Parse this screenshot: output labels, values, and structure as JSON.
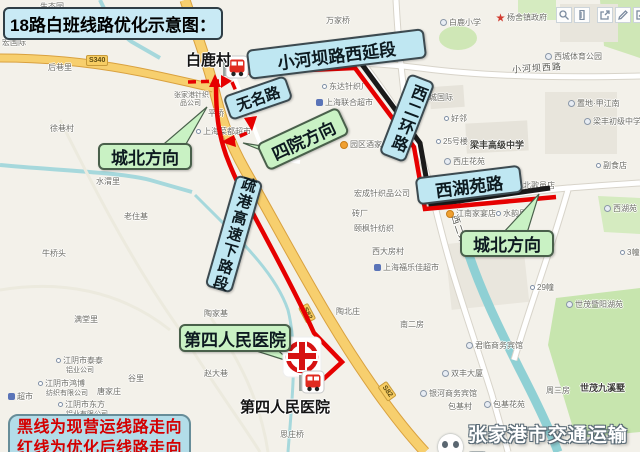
{
  "title": "18路白班线路优化示意图：",
  "legend": {
    "line1": "黑线为现营运线路走向",
    "line2": "红线为优化后线路走向"
  },
  "watermark": "张家港市交通运输局",
  "callouts": {
    "xiaoheba": "小河坝路西延段",
    "wuming": "无名路",
    "siyuan": "四院方向",
    "xierhuan": "西二环路",
    "xihuyuan": "西湖苑路",
    "chengbei_left": "城北方向",
    "chengbei_right": "城北方向",
    "shugang": "疏港高速下路段",
    "hospital": "第四人民医院"
  },
  "stops": {
    "bailucun": "白鹿村",
    "hospital": "第四人民医院"
  },
  "road_shields": {
    "s340": "S340",
    "s82": "S82"
  },
  "toolbar": {
    "zoom": "zoom",
    "measure": "measure",
    "share": "share",
    "draw": "draw",
    "note": "note"
  },
  "colors": {
    "route_current": "#1a1a1a",
    "route_optimized": "#e60000",
    "callout_blue": "#bfe7f2",
    "callout_green": "#c9f2c4",
    "legend_bg": "#b3dde9",
    "legend_text": "#d40000",
    "title_bg": "#c9eaf5"
  },
  "map_labels": [
    {
      "t": "生态园",
      "x": 40,
      "y": 2
    },
    {
      "t": "宏国际",
      "x": 2,
      "y": 38
    },
    {
      "t": "后巷里",
      "x": 48,
      "y": 63
    },
    {
      "t": "徐巷村",
      "x": 50,
      "y": 124
    },
    {
      "t": "万家桥",
      "x": 326,
      "y": 16
    },
    {
      "t": "白鹿小学",
      "x": 440,
      "y": 18,
      "i": "a"
    },
    {
      "t": "杨舍镇政府",
      "x": 496,
      "y": 13,
      "i": "star"
    },
    {
      "t": "西城体育公园",
      "x": 545,
      "y": 52,
      "i": "a"
    },
    {
      "t": "小河坝西路",
      "x": 512,
      "y": 64,
      "c": "street",
      "r": -4
    },
    {
      "t": "置地·甲江南",
      "x": 568,
      "y": 99,
      "i": "a"
    },
    {
      "t": "梁丰初级中学",
      "x": 584,
      "y": 117,
      "i": "a"
    },
    {
      "t": "尚城国际",
      "x": 412,
      "y": 93,
      "i": "a"
    },
    {
      "t": "好邻",
      "x": 444,
      "y": 114,
      "i": "o"
    },
    {
      "t": "25号楼",
      "x": 436,
      "y": 137,
      "i": "o"
    },
    {
      "t": "梁丰高级中学",
      "x": 470,
      "y": 141,
      "c": "em"
    },
    {
      "t": "西庄花苑",
      "x": 444,
      "y": 157,
      "i": "a"
    },
    {
      "t": "东达针织厂",
      "x": 322,
      "y": 82,
      "i": "o"
    },
    {
      "t": "上海联合超市",
      "x": 316,
      "y": 98,
      "i": "m"
    },
    {
      "t": "园区酒家",
      "x": 340,
      "y": 140,
      "i": "smile"
    },
    {
      "t": "张家港针织",
      "x": 174,
      "y": 90,
      "c": "tiny"
    },
    {
      "t": "品公司",
      "x": 180,
      "y": 98,
      "c": "tiny"
    },
    {
      "t": "平桥",
      "x": 208,
      "y": 109
    },
    {
      "t": "上海菜都超市",
      "x": 196,
      "y": 127,
      "i": "o"
    },
    {
      "t": "水渭里",
      "x": 96,
      "y": 177
    },
    {
      "t": "老住基",
      "x": 124,
      "y": 212
    },
    {
      "t": "牛桥头",
      "x": 42,
      "y": 249
    },
    {
      "t": "满堂里",
      "x": 74,
      "y": 315
    },
    {
      "t": "陶家基",
      "x": 204,
      "y": 309
    },
    {
      "t": "谷里",
      "x": 128,
      "y": 374
    },
    {
      "t": "唐家庄",
      "x": 97,
      "y": 387
    },
    {
      "t": "江阴市泰泰",
      "x": 56,
      "y": 356,
      "i": "o"
    },
    {
      "t": "铝业公司",
      "x": 66,
      "y": 365,
      "c": "tiny"
    },
    {
      "t": "江阴市鸿博",
      "x": 38,
      "y": 379,
      "i": "o"
    },
    {
      "t": "纺织有限公司",
      "x": 46,
      "y": 388,
      "c": "tiny"
    },
    {
      "t": "江阴市东方",
      "x": 58,
      "y": 400,
      "i": "o"
    },
    {
      "t": "铝业有限公司",
      "x": 66,
      "y": 409,
      "c": "tiny"
    },
    {
      "t": "超市",
      "x": 8,
      "y": 392,
      "i": "m"
    },
    {
      "t": "赵大巷",
      "x": 204,
      "y": 369
    },
    {
      "t": "思庄桥",
      "x": 280,
      "y": 430
    },
    {
      "t": "宏成针织品公司",
      "x": 354,
      "y": 189
    },
    {
      "t": "砖厂",
      "x": 352,
      "y": 209
    },
    {
      "t": "颐枫针纺织",
      "x": 354,
      "y": 224
    },
    {
      "t": "西大房村",
      "x": 372,
      "y": 247
    },
    {
      "t": "上海福乐佳超市",
      "x": 374,
      "y": 263,
      "i": "m"
    },
    {
      "t": "西二环路",
      "x": 440,
      "y": 230,
      "c": "street",
      "r": 72
    },
    {
      "t": "陶北庄",
      "x": 336,
      "y": 307
    },
    {
      "t": "南二房",
      "x": 400,
      "y": 320
    },
    {
      "t": "北歌邑店",
      "x": 516,
      "y": 181,
      "i": "o"
    },
    {
      "t": "江南家宴店",
      "x": 446,
      "y": 209,
      "i": "smile"
    },
    {
      "t": "水韵里",
      "x": 496,
      "y": 209,
      "i": "o"
    },
    {
      "t": "副食店",
      "x": 596,
      "y": 161,
      "i": "o"
    },
    {
      "t": "西湖苑",
      "x": 604,
      "y": 204,
      "i": "a"
    },
    {
      "t": "3幢",
      "x": 620,
      "y": 248,
      "i": "o"
    },
    {
      "t": "29幢",
      "x": 530,
      "y": 283,
      "i": "o"
    },
    {
      "t": "世茂暨阳湖苑",
      "x": 566,
      "y": 300,
      "i": "a"
    },
    {
      "t": "君临商务宾馆",
      "x": 466,
      "y": 341,
      "i": "a"
    },
    {
      "t": "双丰大厦",
      "x": 442,
      "y": 369,
      "i": "a"
    },
    {
      "t": "银河商务宾馆",
      "x": 420,
      "y": 389,
      "i": "a"
    },
    {
      "t": "包基村",
      "x": 448,
      "y": 402
    },
    {
      "t": "包基花苑",
      "x": 484,
      "y": 400,
      "i": "a"
    },
    {
      "t": "周三房",
      "x": 546,
      "y": 386
    },
    {
      "t": "世茂九溪墅",
      "x": 580,
      "y": 384,
      "c": "em"
    }
  ]
}
